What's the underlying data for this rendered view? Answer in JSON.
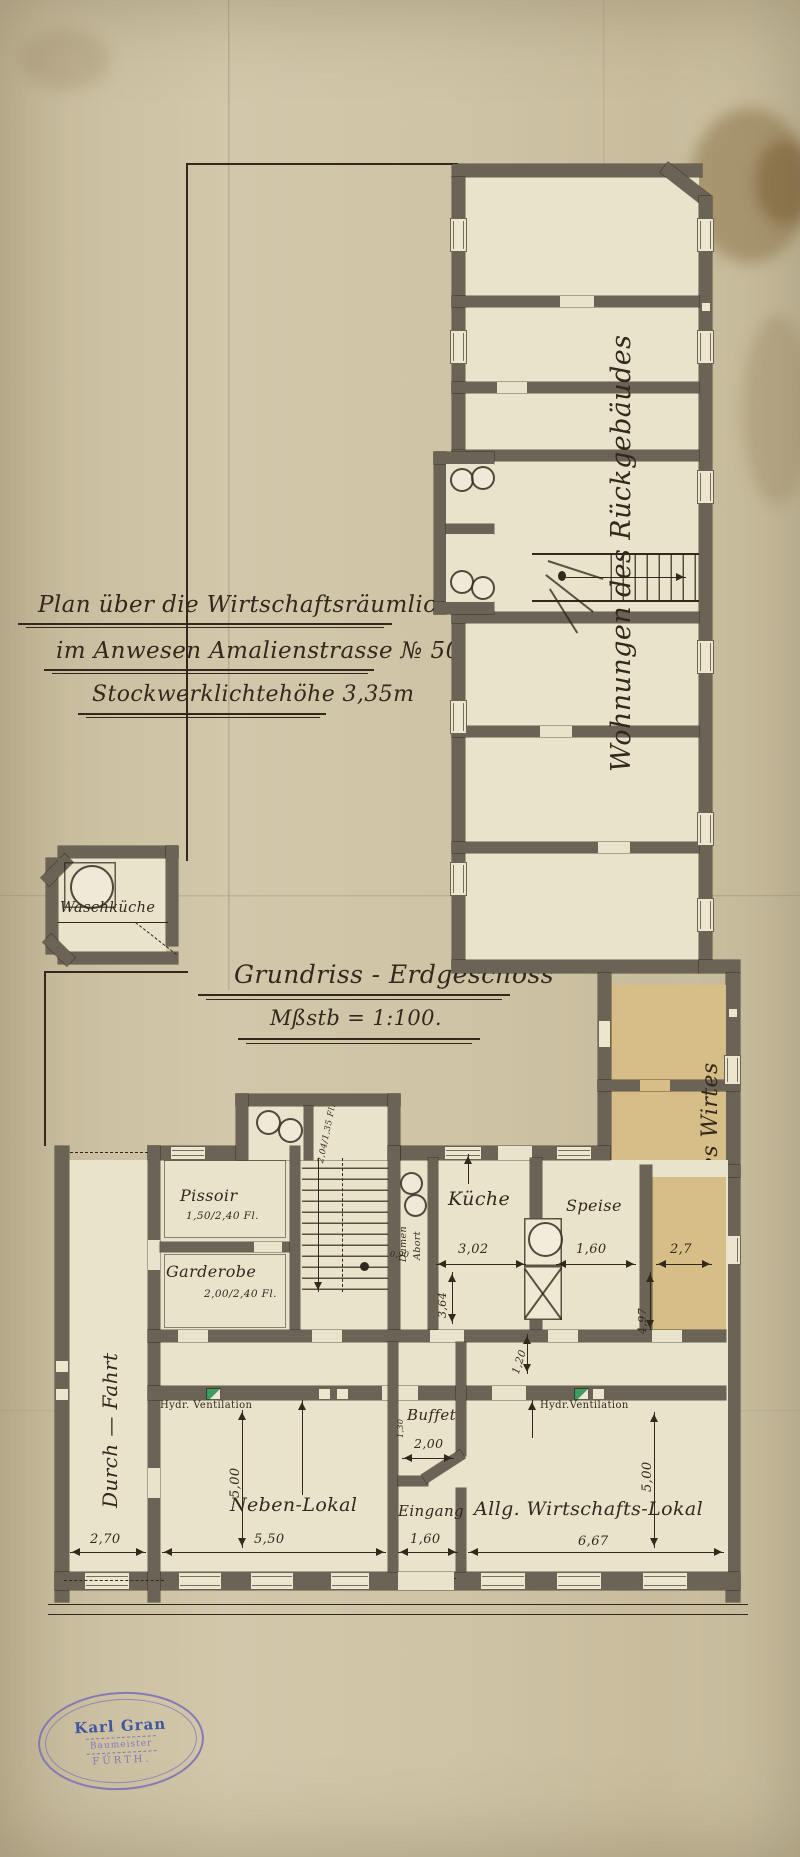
{
  "colors": {
    "paper": "#cdc2a4",
    "wall": "#6b6456",
    "ink": "#32291c",
    "room": "#e9e3cc",
    "stain": "#d7bd86",
    "vent": "#3e9d5e",
    "stampPurple": "#8578b6",
    "stampBlue": "#3f55a0"
  },
  "title_block": {
    "line1": "Plan über die Wirtschaftsräumlichkeiten",
    "line2": "im Anwesen Amalienstrasse № 50.",
    "line3": "Stockwerklichtehöhe 3,35m"
  },
  "plan_caption": {
    "title": "Grundriss - Erdgeschoss",
    "scale": "Mßstb = 1:100."
  },
  "wings": {
    "rear_label": "Wohnungen des Rückgebäudes",
    "owner_label": "Wohnung des Wirtes"
  },
  "rooms": {
    "waschkueche": "Waschküche",
    "pissoir": "Pissoir",
    "pissoir_size": "1,50/2,40 Fl.",
    "garderobe": "Garderobe",
    "garderobe_size": "2,00/2,40 Fl.",
    "kueche": "Küche",
    "speise": "Speise",
    "buffet": "Buffet",
    "eingang": "Eingang",
    "neben_lokal": "Neben-Lokal",
    "allg_lokal": "Allg. Wirtschafts-Lokal",
    "damen": "Damen",
    "abort": "Abort",
    "abort_note": "2,04/1,35 Fl.",
    "durchfahrt": "Durch — Fahrt"
  },
  "annotations": {
    "hydr_vent_left": "Hydr. Ventilation",
    "hydr_vent_right": "Hydr.Ventilation"
  },
  "dimensions": {
    "passage_width": "2,70",
    "neben_width": "5,50",
    "eingang_width": "1,60",
    "allg_width": "6,67",
    "neben_depth": "5,00",
    "allg_depth": "5,00",
    "buffet_width": "2,00",
    "buffet_depth": "1,30",
    "kueche_width": "3,02",
    "kueche_depth": "3,64",
    "abort_width": "0,90",
    "speise_width": "1,60",
    "wirt_width": "2,7",
    "wirt_depth": "4,97",
    "corridor_width": "1,20"
  },
  "stamp": {
    "name": "Karl Gran",
    "title": "Baumeister",
    "city": "FÜRTH."
  }
}
